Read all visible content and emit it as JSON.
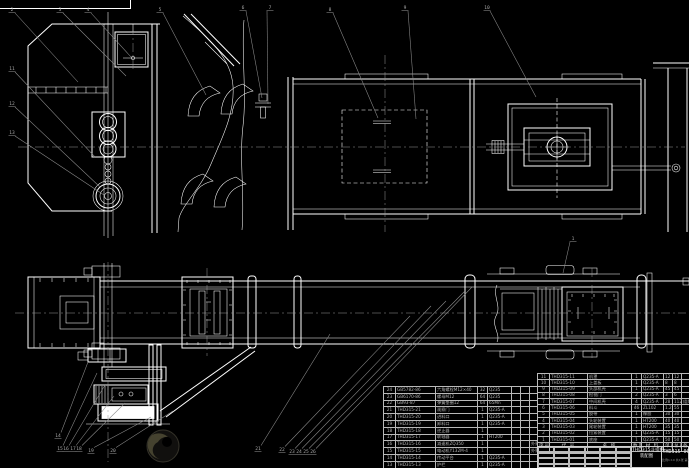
{
  "drawing": {
    "type_label": "bucket-elevator assembly drawing",
    "title": "THD315斗提机",
    "subtitle": "装配图",
    "drawing_no": "THD315-00",
    "sheet_info": "比例1:10 共1张 第1张",
    "colors": {
      "background": "#000000",
      "line": "#ffffff",
      "leader_gray": "#8d8d8d",
      "table_text": "#b3b3b3"
    }
  },
  "bom_right": {
    "headers": [
      "序号",
      "代 号",
      "名 称",
      "数量",
      "材 料",
      "单重",
      "总重",
      "备注"
    ],
    "rows": [
      [
        "11",
        "THD315-11",
        "机罩",
        "1",
        "Q235-A",
        "12",
        "12",
        ""
      ],
      [
        "10",
        "THD315-10",
        "上盖板",
        "1",
        "Q235-A",
        "8",
        "8",
        ""
      ],
      [
        "9",
        "THD315-09",
        "头部机壳",
        "1",
        "Q235-A",
        "45",
        "45",
        ""
      ],
      [
        "8",
        "THD315-08",
        "检视门",
        "2",
        "Q235-A",
        "3",
        "6",
        ""
      ],
      [
        "7",
        "THD315-07",
        "中间机壳",
        "4",
        "Q235-A",
        "28",
        "112",
        "组焊件"
      ],
      [
        "6",
        "THD315-06",
        "料斗",
        "46",
        "ZL102",
        "1.2",
        "55",
        ""
      ],
      [
        "5",
        "THD315-05",
        "胶带",
        "1",
        "橡胶",
        "30",
        "30",
        ""
      ],
      [
        "4",
        "THD315-04",
        "头轮装置",
        "1",
        "HT200",
        "40",
        "40",
        ""
      ],
      [
        "3",
        "THD315-03",
        "尾轮装置",
        "1",
        "HT200",
        "35",
        "35",
        ""
      ],
      [
        "2",
        "THD315-02",
        "拉紧装置",
        "1",
        "Q235-A",
        "15",
        "15",
        ""
      ],
      [
        "1",
        "THD315-01",
        "底座",
        "1",
        "Q235-A",
        "50",
        "50",
        ""
      ]
    ]
  },
  "bom_left": {
    "rows": [
      [
        "24",
        "GB5782-86",
        "六角螺栓M12×40",
        "32",
        "Q235",
        "",
        "",
        ""
      ],
      [
        "23",
        "GB6170-86",
        "螺母M12",
        "64",
        "Q235",
        "",
        "",
        ""
      ],
      [
        "22",
        "GB93-87",
        "弹簧垫圈12",
        "64",
        "65Mn",
        "",
        "",
        ""
      ],
      [
        "21",
        "THD315-21",
        "观察门",
        "1",
        "Q235-A",
        "",
        "",
        ""
      ],
      [
        "20",
        "THD315-20",
        "进料口",
        "1",
        "Q235-A",
        "",
        "",
        ""
      ],
      [
        "19",
        "THD315-19",
        "卸料口",
        "1",
        "Q235-A",
        "",
        "",
        ""
      ],
      [
        "18",
        "THD315-18",
        "逆止器",
        "1",
        "",
        "",
        "",
        ""
      ],
      [
        "17",
        "THD315-17",
        "联轴器",
        "1",
        "HT200",
        "",
        "",
        ""
      ],
      [
        "16",
        "THD315-16",
        "减速机ZQ350",
        "1",
        "",
        "",
        "",
        "外购"
      ],
      [
        "15",
        "THD315-15",
        "电动机Y132M-4",
        "1",
        "",
        "",
        "",
        "外购"
      ],
      [
        "14",
        "THD315-14",
        "传动平台",
        "1",
        "Q235-A",
        "",
        "",
        ""
      ],
      [
        "13",
        "THD315-13",
        "护栏",
        "1",
        "Q235-A",
        "",
        "",
        ""
      ],
      [
        "12",
        "THD315-12",
        "下料斗",
        "1",
        "Q235-A",
        "",
        "",
        ""
      ]
    ]
  },
  "balloons": [
    {
      "n": "2",
      "x": 12,
      "y": 11,
      "lx": 78,
      "ly": 82
    },
    {
      "n": "3",
      "x": 60,
      "y": 11,
      "lx": 126,
      "ly": 76
    },
    {
      "n": "4",
      "x": 88,
      "y": 11,
      "lx": 131,
      "ly": 57
    },
    {
      "n": "5",
      "x": 160,
      "y": 11,
      "lx": 206,
      "ly": 95
    },
    {
      "n": "6",
      "x": 243,
      "y": 9,
      "lx": 262,
      "ly": 98
    },
    {
      "n": "7",
      "x": 270,
      "y": 9,
      "lx": 268,
      "ly": 104
    },
    {
      "n": "8",
      "x": 330,
      "y": 11,
      "lx": 378,
      "ly": 118
    },
    {
      "n": "9",
      "x": 405,
      "y": 9,
      "lx": 416,
      "ly": 119
    },
    {
      "n": "10",
      "x": 487,
      "y": 9,
      "lx": 536,
      "ly": 97
    },
    {
      "n": "11",
      "x": 12,
      "y": 70,
      "lx": 95,
      "ly": 157
    },
    {
      "n": "12",
      "x": 12,
      "y": 105,
      "lx": 100,
      "ly": 187
    },
    {
      "n": "13",
      "x": 12,
      "y": 134,
      "lx": 104,
      "ly": 195
    },
    {
      "n": "1",
      "x": 573,
      "y": 240,
      "lx": 563,
      "ly": 273
    },
    {
      "n": "14",
      "x": 58,
      "y": 437,
      "lx": 88,
      "ly": 362
    },
    {
      "n": "15",
      "x": 60,
      "y": 450,
      "lx": 97,
      "ly": 373
    },
    {
      "n": "16",
      "x": 66,
      "y": 450,
      "lx": 105,
      "ly": 385
    },
    {
      "n": "17",
      "x": 73,
      "y": 450,
      "lx": 114,
      "ly": 396
    },
    {
      "n": "18",
      "x": 79,
      "y": 450,
      "lx": 125,
      "ly": 403
    },
    {
      "n": "19",
      "x": 91,
      "y": 452,
      "lx": 151,
      "ly": 417
    },
    {
      "n": "20",
      "x": 113,
      "y": 452,
      "lx": 173,
      "ly": 411
    },
    {
      "n": "21",
      "x": 258,
      "y": 450,
      "lx": 330,
      "ly": 334
    },
    {
      "n": "22",
      "x": 282,
      "y": 451,
      "lx": 410,
      "ly": 316
    },
    {
      "n": "23",
      "x": 292,
      "y": 453,
      "lx": 431,
      "ly": 306
    },
    {
      "n": "24",
      "x": 299,
      "y": 453,
      "lx": 446,
      "ly": 301
    },
    {
      "n": "25",
      "x": 306,
      "y": 453,
      "lx": 465,
      "ly": 291
    },
    {
      "n": "26",
      "x": 313,
      "y": 453,
      "lx": 472,
      "ly": 287
    }
  ]
}
